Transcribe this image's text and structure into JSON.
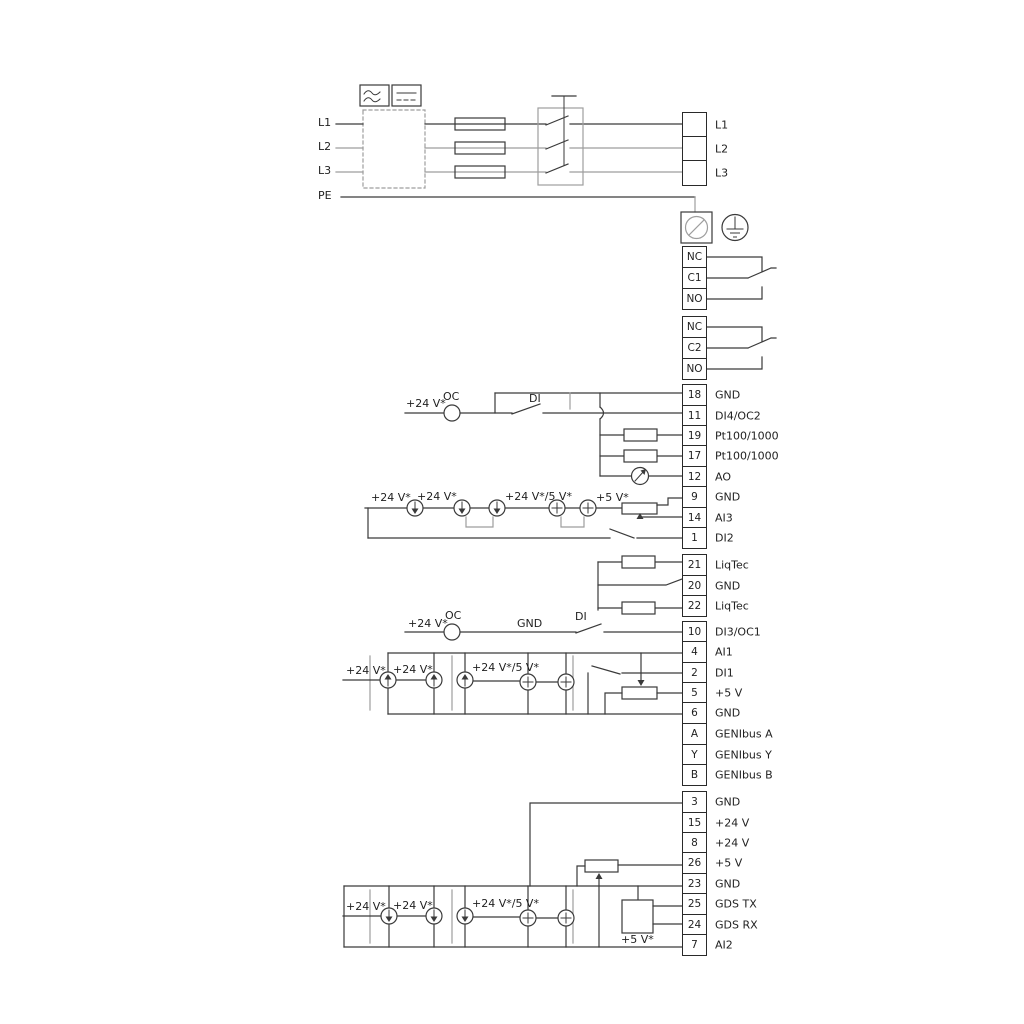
{
  "labels": {
    "l1": "L1",
    "l2": "L2",
    "l3": "L3",
    "pe": "PE",
    "plus24": "+24 V*",
    "plus24or5": "+24 V*/5 V*",
    "plus5": "+5 V*",
    "oc": "OC",
    "di": "DI",
    "gnd": "GND"
  },
  "terminals": {
    "power": {
      "cells": [
        {
          "n": "",
          "label": "L1"
        },
        {
          "n": "",
          "label": "L2"
        },
        {
          "n": "",
          "label": "L3"
        }
      ]
    },
    "relay1": {
      "cells": [
        {
          "n": "NC",
          "label": ""
        },
        {
          "n": "C1",
          "label": ""
        },
        {
          "n": "NO",
          "label": ""
        }
      ]
    },
    "relay2": {
      "cells": [
        {
          "n": "NC",
          "label": ""
        },
        {
          "n": "C2",
          "label": ""
        },
        {
          "n": "NO",
          "label": ""
        }
      ]
    },
    "io1": {
      "cells": [
        {
          "n": "18",
          "label": "GND"
        },
        {
          "n": "11",
          "label": "DI4/OC2"
        },
        {
          "n": "19",
          "label": "Pt100/1000"
        },
        {
          "n": "17",
          "label": "Pt100/1000"
        },
        {
          "n": "12",
          "label": "AO"
        },
        {
          "n": "9",
          "label": "GND"
        },
        {
          "n": "14",
          "label": "AI3"
        },
        {
          "n": "1",
          "label": "DI2"
        }
      ]
    },
    "liqtec": {
      "cells": [
        {
          "n": "21",
          "label": "LiqTec"
        },
        {
          "n": "20",
          "label": "GND"
        },
        {
          "n": "22",
          "label": "LiqTec"
        }
      ]
    },
    "di3": {
      "cells": [
        {
          "n": "10",
          "label": "DI3/OC1"
        }
      ]
    },
    "ai1": {
      "cells": [
        {
          "n": "4",
          "label": "AI1"
        },
        {
          "n": "2",
          "label": "DI1"
        },
        {
          "n": "5",
          "label": "+5 V"
        },
        {
          "n": "6",
          "label": "GND"
        }
      ]
    },
    "genibus": {
      "cells": [
        {
          "n": "A",
          "label": "GENIbus A"
        },
        {
          "n": "Y",
          "label": "GENIbus Y"
        },
        {
          "n": "B",
          "label": "GENIbus B"
        }
      ]
    },
    "io2": {
      "cells": [
        {
          "n": "3",
          "label": "GND"
        },
        {
          "n": "15",
          "label": "+24 V"
        },
        {
          "n": "8",
          "label": "+24 V"
        },
        {
          "n": "26",
          "label": "+5 V"
        },
        {
          "n": "23",
          "label": "GND"
        },
        {
          "n": "25",
          "label": "GDS TX"
        },
        {
          "n": "24",
          "label": "GDS RX"
        },
        {
          "n": "7",
          "label": "AI2"
        }
      ]
    }
  },
  "colors": {
    "wire_dark": "#3a3a3a",
    "wire_gray": "#9e9e9e"
  }
}
